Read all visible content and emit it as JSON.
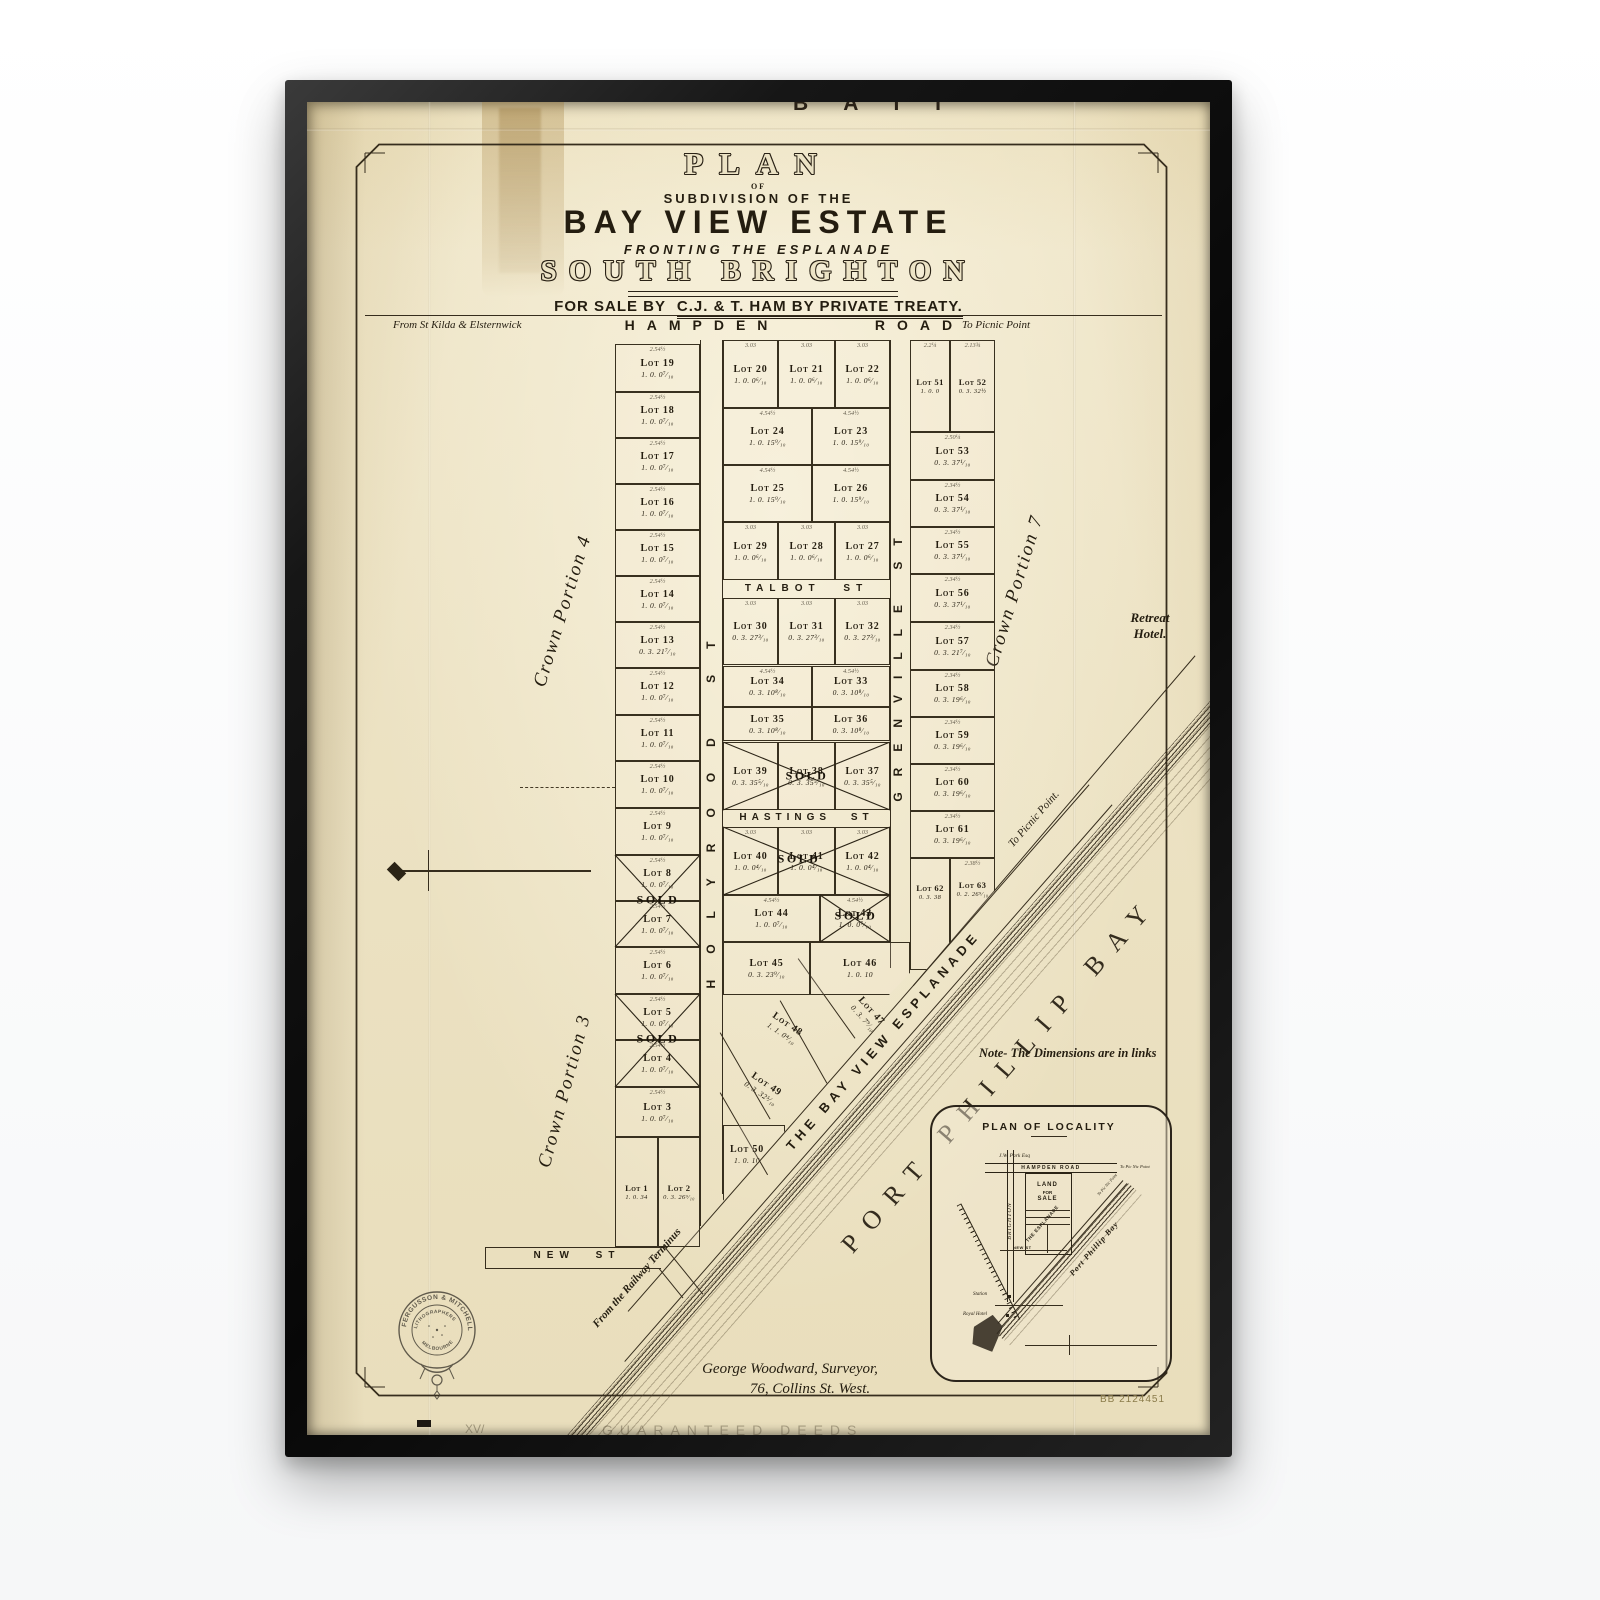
{
  "title": {
    "plan": "PLAN",
    "of": "OF",
    "subdivision": "SUBDIVISION OF THE",
    "estate": "BAY VIEW ESTATE",
    "fronting": "FRONTING THE ESPLANADE",
    "locality": "SOUTH BRIGHTON",
    "sale_prefix": "FOR SALE BY",
    "sale_rest": "C.J. & T. HAM BY PRIVATE TREATY."
  },
  "roads": {
    "hampden_left": "From St Kilda & Elsternwick",
    "hampden": "HAMPDEN",
    "road_word": "ROAD",
    "hampden_right": "To Picnic Point",
    "talbot": "TALBOT ST",
    "hastings": "HASTINGS ST",
    "holyrood": "HOLYROOD ST",
    "grenville": "GRENVILLE ST",
    "new_st": "NEW ST",
    "esplanade": "THE BAY VIEW ESPLANADE",
    "esplanade_to": "To Picnic Point.",
    "railway_from": "From the Railway Terminus"
  },
  "annotations": {
    "crown4": "Crown Portion 4",
    "crown3": "Crown Portion 3",
    "crown7": "Crown Portion 7",
    "retreat": "Retreat Hotel.",
    "bay": "PORT PHILLIP BAY",
    "note": "Note- The Dimensions are in links",
    "top_partial": "B A I I",
    "surveyor1": "George Woodward, Surveyor,",
    "surveyor2": "76, Collins St. West.",
    "catalog": "BB 2124451",
    "bottom_faint": "GUARANTEED DEEDS",
    "bottom_faint_left": "XV/"
  },
  "stamp": {
    "arc": "FERGUSSON & MITCHELL",
    "line1": "LITHOGRAPHERS",
    "line2": "MELBOURNE"
  },
  "inset": {
    "title": "PLAN OF LOCALITY",
    "owner": "J.W. Park Esq",
    "hampden": "HAMPDEN ROAD",
    "to_right": "To Pic Nic Point",
    "brighton": "BRIGHTON",
    "land1": "LAND",
    "land2": "FOR",
    "land3": "SALE",
    "esplanade": "THE ESPLANADE",
    "esp_to": "To Pic Nic Point",
    "bay": "Port Phillip Bay",
    "new_st": "NEW ST",
    "station": "Station",
    "hotel": "Royal Hotel"
  },
  "sold_label": "SOLD",
  "ink": "#2b2416",
  "paper_color": "#ece3c5",
  "lots": [
    {
      "n": "Lot 1",
      "a": "1. 0. 34",
      "x": 308,
      "y": 1035,
      "w": 43,
      "h": 110,
      "sm": 1
    },
    {
      "n": "Lot 2",
      "a": "0. 3. 26⁹⁄₁₀",
      "x": 351,
      "y": 1035,
      "w": 42,
      "h": 110,
      "sm": 1
    },
    {
      "n": "Lot 3",
      "a": "1. 0. 0⁷⁄₁₀",
      "x": 308,
      "y": 985,
      "w": 85,
      "h": 50,
      "d": "2.54½"
    },
    {
      "n": "Lot 4",
      "a": "1. 0. 0⁷⁄₁₀",
      "x": 308,
      "y": 938,
      "w": 85,
      "h": 47,
      "d": "2.54½"
    },
    {
      "n": "Lot 5",
      "a": "1. 0. 0⁷⁄₁₀",
      "x": 308,
      "y": 892,
      "w": 85,
      "h": 46,
      "d": "2.54½"
    },
    {
      "n": "Lot 6",
      "a": "1. 0. 0⁷⁄₁₀",
      "x": 308,
      "y": 845,
      "w": 85,
      "h": 47,
      "d": "2.54½"
    },
    {
      "n": "Lot 7",
      "a": "1. 0. 0⁷⁄₁₀",
      "x": 308,
      "y": 799,
      "w": 85,
      "h": 46,
      "d": "2.54½"
    },
    {
      "n": "Lot 8",
      "a": "1. 0. 0⁷⁄₁₀",
      "x": 308,
      "y": 753,
      "w": 85,
      "h": 46,
      "d": "2.54½"
    },
    {
      "n": "Lot 9",
      "a": "1. 0. 0⁷⁄₁₀",
      "x": 308,
      "y": 706,
      "w": 85,
      "h": 47,
      "d": "2.54½"
    },
    {
      "n": "Lot 10",
      "a": "1. 0. 0⁷⁄₁₀",
      "x": 308,
      "y": 659,
      "w": 85,
      "h": 47,
      "d": "2.54½"
    },
    {
      "n": "Lot 11",
      "a": "1. 0. 0⁷⁄₁₀",
      "x": 308,
      "y": 613,
      "w": 85,
      "h": 46,
      "d": "2.54½"
    },
    {
      "n": "Lot 12",
      "a": "1. 0. 0⁷⁄₁₀",
      "x": 308,
      "y": 566,
      "w": 85,
      "h": 47,
      "d": "2.54½"
    },
    {
      "n": "Lot 13",
      "a": "0. 3. 21⁷⁄₁₀",
      "x": 308,
      "y": 520,
      "w": 85,
      "h": 46,
      "d": "2.54½"
    },
    {
      "n": "Lot 14",
      "a": "1. 0. 0⁷⁄₁₀",
      "x": 308,
      "y": 474,
      "w": 85,
      "h": 46,
      "d": "2.54½"
    },
    {
      "n": "Lot 15",
      "a": "1. 0. 0⁷⁄₁₀",
      "x": 308,
      "y": 428,
      "w": 85,
      "h": 46,
      "d": "2.54½"
    },
    {
      "n": "Lot 16",
      "a": "1. 0. 0⁷⁄₁₀",
      "x": 308,
      "y": 382,
      "w": 85,
      "h": 46,
      "d": "2.54½"
    },
    {
      "n": "Lot 17",
      "a": "1. 0. 0⁷⁄₁₀",
      "x": 308,
      "y": 336,
      "w": 85,
      "h": 46,
      "d": "2.54½"
    },
    {
      "n": "Lot 18",
      "a": "1. 0. 0⁷⁄₁₀",
      "x": 308,
      "y": 290,
      "w": 85,
      "h": 46,
      "d": "2.54½"
    },
    {
      "n": "Lot 19",
      "a": "1. 0. 0⁷⁄₁₀",
      "x": 308,
      "y": 242,
      "w": 85,
      "h": 48,
      "d": "2.54½"
    },
    {
      "n": "Lot 20",
      "a": "1. 0. 0⁶⁄₁₀",
      "x": 416,
      "y": 238,
      "w": 55,
      "h": 68,
      "d": "3.03"
    },
    {
      "n": "Lot 21",
      "a": "1. 0. 0⁶⁄₁₀",
      "x": 471,
      "y": 238,
      "w": 57,
      "h": 68,
      "d": "3.03"
    },
    {
      "n": "Lot 22",
      "a": "1. 0. 0⁶⁄₁₀",
      "x": 528,
      "y": 238,
      "w": 55,
      "h": 68,
      "d": "3.03"
    },
    {
      "n": "Lot 23",
      "a": "1. 0. 15⁹⁄₁₀",
      "x": 505,
      "y": 306,
      "w": 78,
      "h": 57,
      "d": "4.54½"
    },
    {
      "n": "Lot 24",
      "a": "1. 0. 15⁹⁄₁₀",
      "x": 416,
      "y": 306,
      "w": 89,
      "h": 57,
      "d": "4.54½"
    },
    {
      "n": "Lot 25",
      "a": "1. 0. 15⁹⁄₁₀",
      "x": 416,
      "y": 363,
      "w": 89,
      "h": 57,
      "d": "4.54½"
    },
    {
      "n": "Lot 26",
      "a": "1. 0. 15⁹⁄₁₀",
      "x": 505,
      "y": 363,
      "w": 78,
      "h": 57,
      "d": "4.54½"
    },
    {
      "n": "Lot 27",
      "a": "1. 0. 0⁶⁄₁₀",
      "x": 528,
      "y": 420,
      "w": 55,
      "h": 58,
      "d": "3.03"
    },
    {
      "n": "Lot 28",
      "a": "1. 0. 0⁶⁄₁₀",
      "x": 471,
      "y": 420,
      "w": 57,
      "h": 58,
      "d": "3.03"
    },
    {
      "n": "Lot 29",
      "a": "1. 0. 0⁶⁄₁₀",
      "x": 416,
      "y": 420,
      "w": 55,
      "h": 58,
      "d": "3.03"
    },
    {
      "n": "Lot 30",
      "a": "0. 3. 27³⁄₁₀",
      "x": 416,
      "y": 496,
      "w": 55,
      "h": 67,
      "d": "3.03"
    },
    {
      "n": "Lot 31",
      "a": "0. 3. 27³⁄₁₀",
      "x": 471,
      "y": 496,
      "w": 57,
      "h": 67,
      "d": "3.03"
    },
    {
      "n": "Lot 32",
      "a": "0. 3. 27³⁄₁₀",
      "x": 528,
      "y": 496,
      "w": 55,
      "h": 67,
      "d": "3.03"
    },
    {
      "n": "Lot 33",
      "a": "0. 3. 10⁸⁄₁₀",
      "x": 505,
      "y": 564,
      "w": 78,
      "h": 41,
      "d": "4.54½"
    },
    {
      "n": "Lot 34",
      "a": "0. 3. 10⁸⁄₁₀",
      "x": 416,
      "y": 564,
      "w": 89,
      "h": 41,
      "d": "4.54½"
    },
    {
      "n": "Lot 35",
      "a": "0. 3. 10⁸⁄₁₀",
      "x": 416,
      "y": 605,
      "w": 89,
      "h": 34
    },
    {
      "n": "Lot 36",
      "a": "0. 3. 10⁸⁄₁₀",
      "x": 505,
      "y": 605,
      "w": 78,
      "h": 34
    },
    {
      "n": "Lot 37",
      "a": "0. 3. 35⁵⁄₁₀",
      "x": 528,
      "y": 640,
      "w": 55,
      "h": 68
    },
    {
      "n": "Lot 38",
      "a": "0. 3. 35⁵⁄₁₀",
      "x": 471,
      "y": 640,
      "w": 57,
      "h": 68
    },
    {
      "n": "Lot 39",
      "a": "0. 3. 35⁵⁄₁₀",
      "x": 416,
      "y": 640,
      "w": 55,
      "h": 68
    },
    {
      "n": "Lot 40",
      "a": "1. 0. 0⁴⁄₁₀",
      "x": 416,
      "y": 725,
      "w": 55,
      "h": 68,
      "d": "3.03"
    },
    {
      "n": "Lot 41",
      "a": "1. 0. 0⁴⁄₁₀",
      "x": 471,
      "y": 725,
      "w": 57,
      "h": 68,
      "d": "3.03"
    },
    {
      "n": "Lot 42",
      "a": "1. 0. 0⁴⁄₁₀",
      "x": 528,
      "y": 725,
      "w": 55,
      "h": 68,
      "d": "3.03"
    },
    {
      "n": "Lot 43",
      "a": "1. 0. 0⁷⁄₁₀",
      "x": 513,
      "y": 793,
      "w": 70,
      "h": 47,
      "d": "4.54½"
    },
    {
      "n": "Lot 44",
      "a": "1. 0. 0⁷⁄₁₀",
      "x": 416,
      "y": 793,
      "w": 97,
      "h": 47,
      "d": "4.54½"
    },
    {
      "n": "Lot 45",
      "a": "0. 3. 23⁹⁄₁₀",
      "x": 416,
      "y": 840,
      "w": 87,
      "h": 53
    },
    {
      "n": "Lot 46",
      "a": "1. 0. 10",
      "x": 503,
      "y": 840,
      "w": 100,
      "h": 53,
      "clip": "polygon(0 0,100% 0,100% 58%,79% 100%,0 100%)"
    },
    {
      "n": "Lot 47",
      "a": "0. 3. 7⁹⁄₁₀",
      "x": 518,
      "y": 888,
      "w": 86,
      "h": 48,
      "rot": 48,
      "nb": 1
    },
    {
      "n": "Lot 48",
      "a": "1. 1. 0⁴⁄₁₀",
      "x": 434,
      "y": 898,
      "w": 88,
      "h": 56,
      "rot": 34,
      "nb": 1
    },
    {
      "n": "Lot 49",
      "a": "0. 3. 32⁵⁄₁₀",
      "x": 416,
      "y": 960,
      "w": 82,
      "h": 52,
      "rot": 34,
      "nb": 1
    },
    {
      "n": "Lot 50",
      "a": "1. 0. 10",
      "x": 416,
      "y": 1023,
      "w": 62,
      "h": 85,
      "clip": "polygon(0 0,100% 0,100% 7%,0 89%)",
      "pad": "0 14px 26px 0"
    },
    {
      "n": "Lot 51",
      "a": "1. 0. 0",
      "x": 603,
      "y": 238,
      "w": 40,
      "h": 92,
      "sm": 1,
      "d": "2.2¼"
    },
    {
      "n": "Lot 52",
      "a": "0. 3. 32½",
      "x": 643,
      "y": 238,
      "w": 45,
      "h": 92,
      "sm": 1,
      "d": "2.13¾"
    },
    {
      "n": "Lot 53",
      "a": "0. 3. 37¹⁄₁₀",
      "x": 603,
      "y": 330,
      "w": 85,
      "h": 48,
      "d": "2.50¼"
    },
    {
      "n": "Lot 54",
      "a": "0. 3. 37¹⁄₁₀",
      "x": 603,
      "y": 378,
      "w": 85,
      "h": 47,
      "d": "2.34½"
    },
    {
      "n": "Lot 55",
      "a": "0. 3. 37¹⁄₁₀",
      "x": 603,
      "y": 425,
      "w": 85,
      "h": 47,
      "d": "2.34½"
    },
    {
      "n": "Lot 56",
      "a": "0. 3. 37¹⁄₁₀",
      "x": 603,
      "y": 472,
      "w": 85,
      "h": 48,
      "d": "2.34½"
    },
    {
      "n": "Lot 57",
      "a": "0. 3. 21⁷⁄₁₀",
      "x": 603,
      "y": 520,
      "w": 85,
      "h": 48,
      "d": "2.34½"
    },
    {
      "n": "Lot 58",
      "a": "0. 3. 19⁶⁄₁₀",
      "x": 603,
      "y": 568,
      "w": 85,
      "h": 47,
      "d": "2.34½"
    },
    {
      "n": "Lot 59",
      "a": "0. 3. 19⁶⁄₁₀",
      "x": 603,
      "y": 615,
      "w": 85,
      "h": 47,
      "d": "2.34½"
    },
    {
      "n": "Lot 60",
      "a": "0. 3. 19⁶⁄₁₀",
      "x": 603,
      "y": 662,
      "w": 85,
      "h": 47,
      "d": "2.34½"
    },
    {
      "n": "Lot 61",
      "a": "0. 3. 19⁶⁄₁₀",
      "x": 603,
      "y": 709,
      "w": 85,
      "h": 47,
      "d": "2.34½"
    },
    {
      "n": "Lot 62",
      "a": "0. 3. 38",
      "x": 603,
      "y": 756,
      "w": 40,
      "h": 112,
      "sm": 1,
      "pad": "0 0 44px 0",
      "clip": "polygon(0 0,100% 0,100% 75%,40% 100%,0 100%)"
    },
    {
      "n": "Lot 63",
      "a": "0. 2. 26⁹⁄₁₀",
      "x": 643,
      "y": 756,
      "w": 45,
      "h": 84,
      "sm": 1,
      "d": "2.38½",
      "pad": "0 0 22px 0",
      "clip": "polygon(0 0,100% 0,100% 39%,1% 100%,0 100%)"
    }
  ],
  "crosses": [
    {
      "x": 308,
      "y": 753,
      "w": 85,
      "h": 92,
      "sx": 351,
      "sy": 798
    },
    {
      "x": 308,
      "y": 892,
      "w": 85,
      "h": 93,
      "sx": 351,
      "sy": 937
    },
    {
      "x": 416,
      "y": 640,
      "w": 167,
      "h": 68,
      "sx": 500,
      "sy": 674
    },
    {
      "x": 416,
      "y": 725,
      "w": 167,
      "h": 68,
      "sx": 492,
      "sy": 757
    },
    {
      "x": 513,
      "y": 793,
      "w": 70,
      "h": 47,
      "sx": 549,
      "sy": 814
    }
  ]
}
